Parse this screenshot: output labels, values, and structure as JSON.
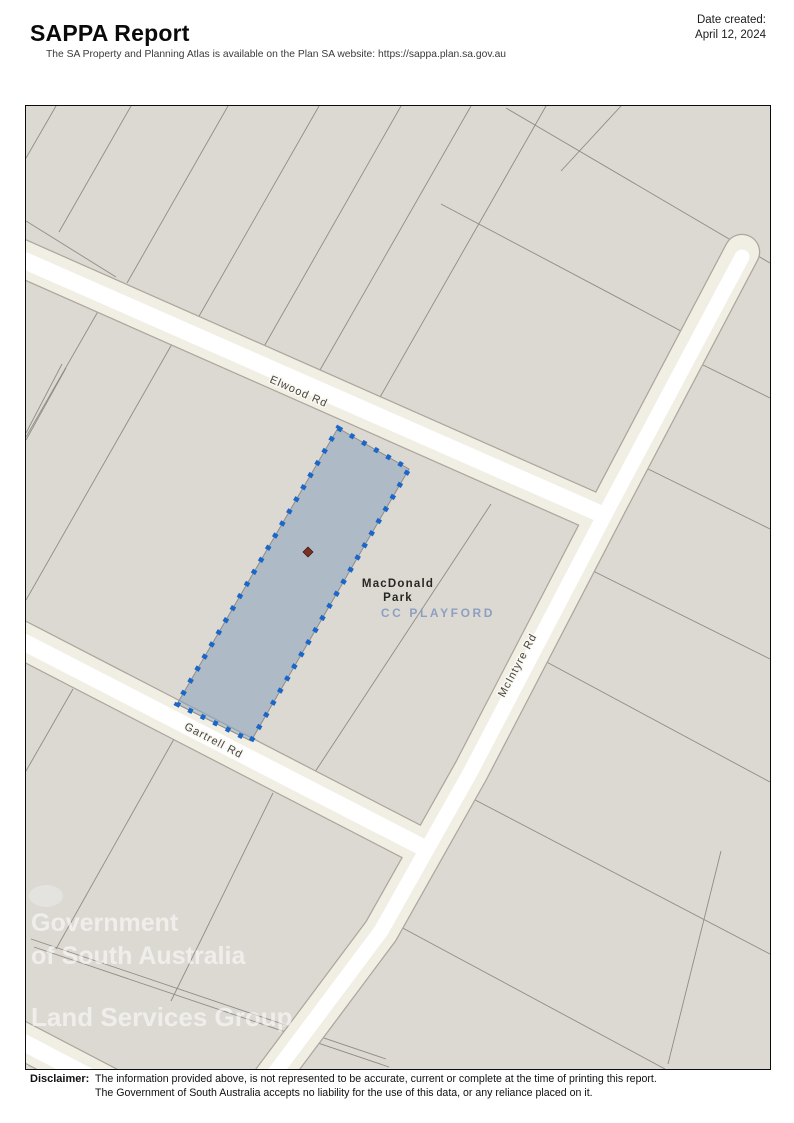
{
  "header": {
    "title": "SAPPA Report",
    "subtitle": "The SA Property and Planning Atlas is available on the Plan SA website: https://sappa.plan.sa.gov.au",
    "date_created_label": "Date created:",
    "date_created_value": "April 12, 2024"
  },
  "map": {
    "road_labels": {
      "elwood": "Elwood Rd",
      "mcintyre": "McIntyre Rd",
      "gartrell": "Gartrell Rd"
    },
    "place_labels": {
      "suburb_line1": "MacDonald",
      "suburb_line2": "Park",
      "council_area": "CC PLAYFORD"
    },
    "watermark": {
      "line1": "Government",
      "line2": "of South Australia",
      "line3": "Land Services Group"
    },
    "colors": {
      "map_background": "#dcd9d3",
      "parcel_line": "#8f8c85",
      "road_fill": "#f1eee4",
      "road_core": "#ffffff",
      "road_casing": "#aca79c",
      "selected_parcel_fill": "rgba(127,156,185,0.5)",
      "selected_parcel_dots": "#1a67c9",
      "centroid_marker": "#7b3222",
      "council_label": "#8da0c2"
    }
  },
  "footer": {
    "disclaimer_label": "Disclaimer:",
    "line1": "The information provided above, is not represented to be accurate, current or complete at the time of printing this report.",
    "line2": "The Government of South Australia accepts no liability for the use of this data, or any reliance placed on it."
  }
}
